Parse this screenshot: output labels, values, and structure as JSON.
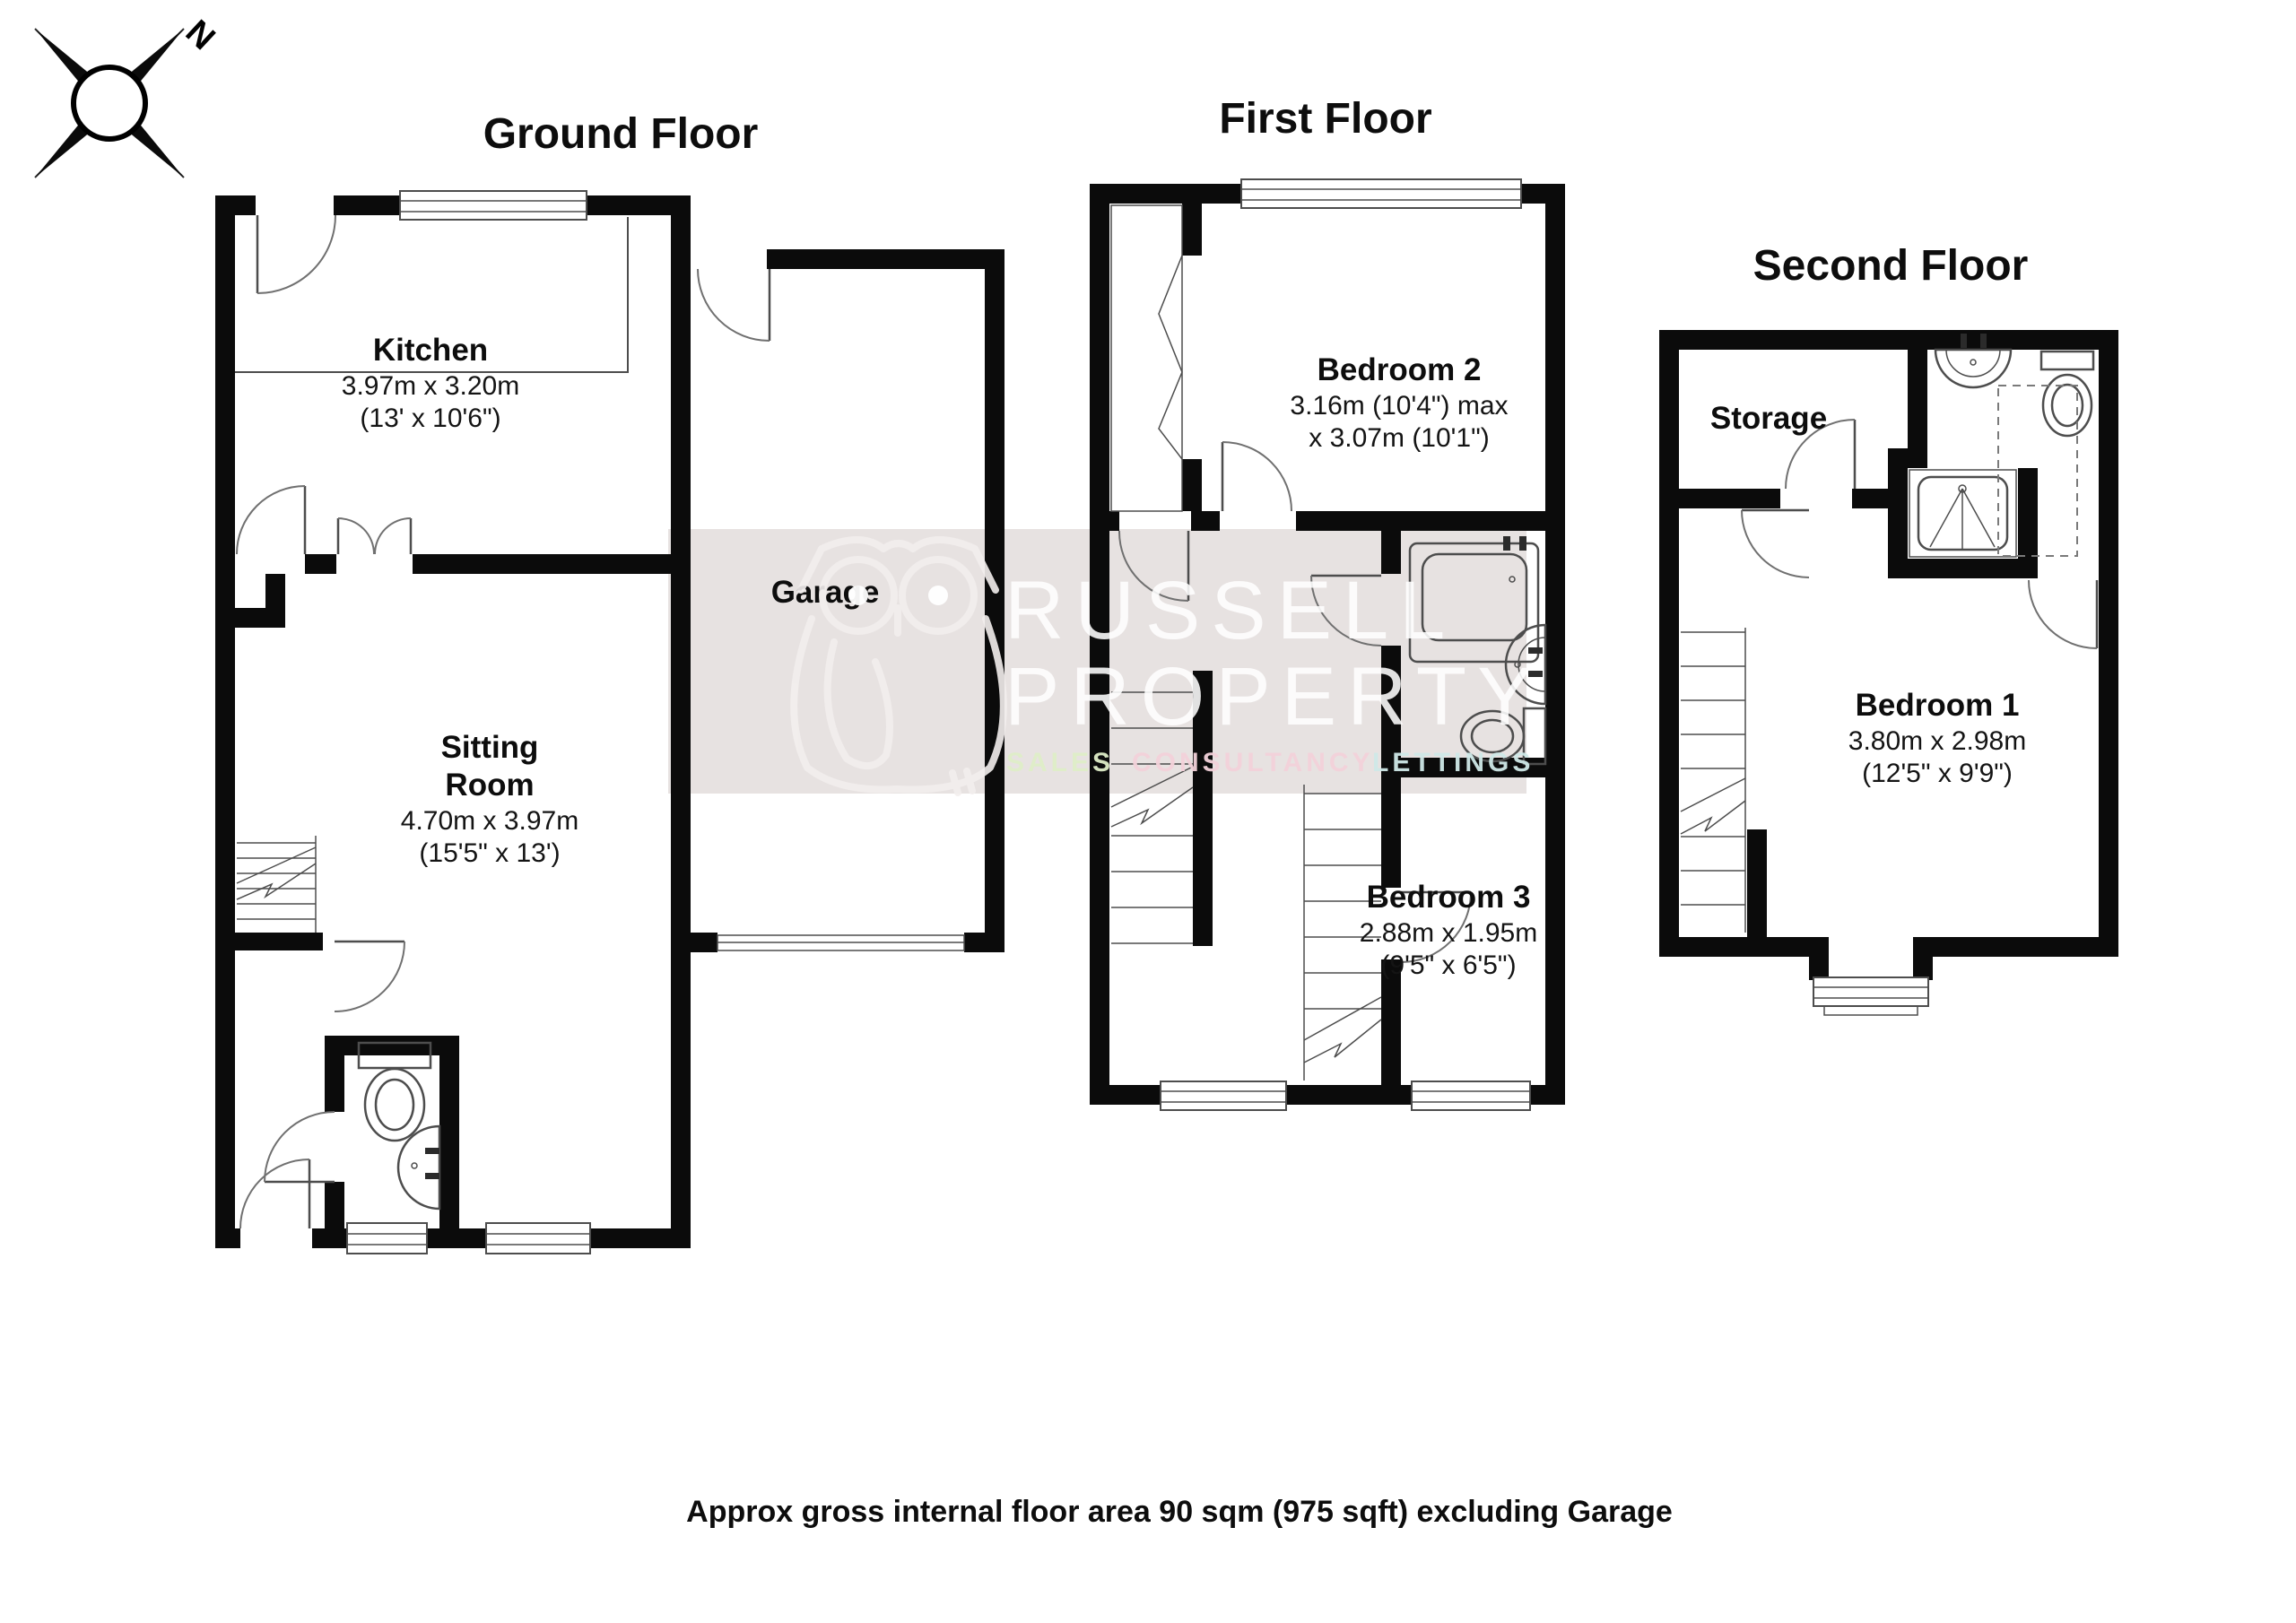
{
  "page": {
    "background": "#ffffff",
    "caption": "Approx gross internal floor area 90 sqm (975 sqft) excluding Garage"
  },
  "compass": {
    "north_label": "N"
  },
  "watermark": {
    "band_color": "#e7e2e1",
    "brand_line1": "RUSSELL",
    "brand_line2": "PROPERTY",
    "tagline": {
      "sales": "SALES",
      "consultancy": "CONSULTANCY",
      "lettings": "LETTINGS"
    },
    "tagline_colors": {
      "sales": "#dfeec8",
      "consultancy": "#f3d2da",
      "lettings": "#cfe9e8"
    },
    "owl_icon": "owl-logo"
  },
  "ground": {
    "title": "Ground Floor",
    "kitchen": {
      "name": "Kitchen",
      "dims_m": "3.97m x 3.20m",
      "dims_ft": "(13' x 10'6\")"
    },
    "garage": {
      "name": "Garage"
    },
    "sitting": {
      "name_line1": "Sitting",
      "name_line2": "Room",
      "dims_m": "4.70m x 3.97m",
      "dims_ft": "(15'5\" x 13')"
    }
  },
  "first": {
    "title": "First Floor",
    "bedroom2": {
      "name": "Bedroom 2",
      "dims_m": "3.16m (10'4\") max",
      "dims_ft": "x 3.07m (10'1\")"
    },
    "bedroom3": {
      "name": "Bedroom 3",
      "dims_m": "2.88m x 1.95m",
      "dims_ft": "(9'5\" x 6'5\")"
    }
  },
  "second": {
    "title": "Second Floor",
    "storage": {
      "name": "Storage"
    },
    "bedroom1": {
      "name": "Bedroom 1",
      "dims_m": "3.80m x 2.98m",
      "dims_ft": "(12'5\" x 9'9\")"
    }
  }
}
